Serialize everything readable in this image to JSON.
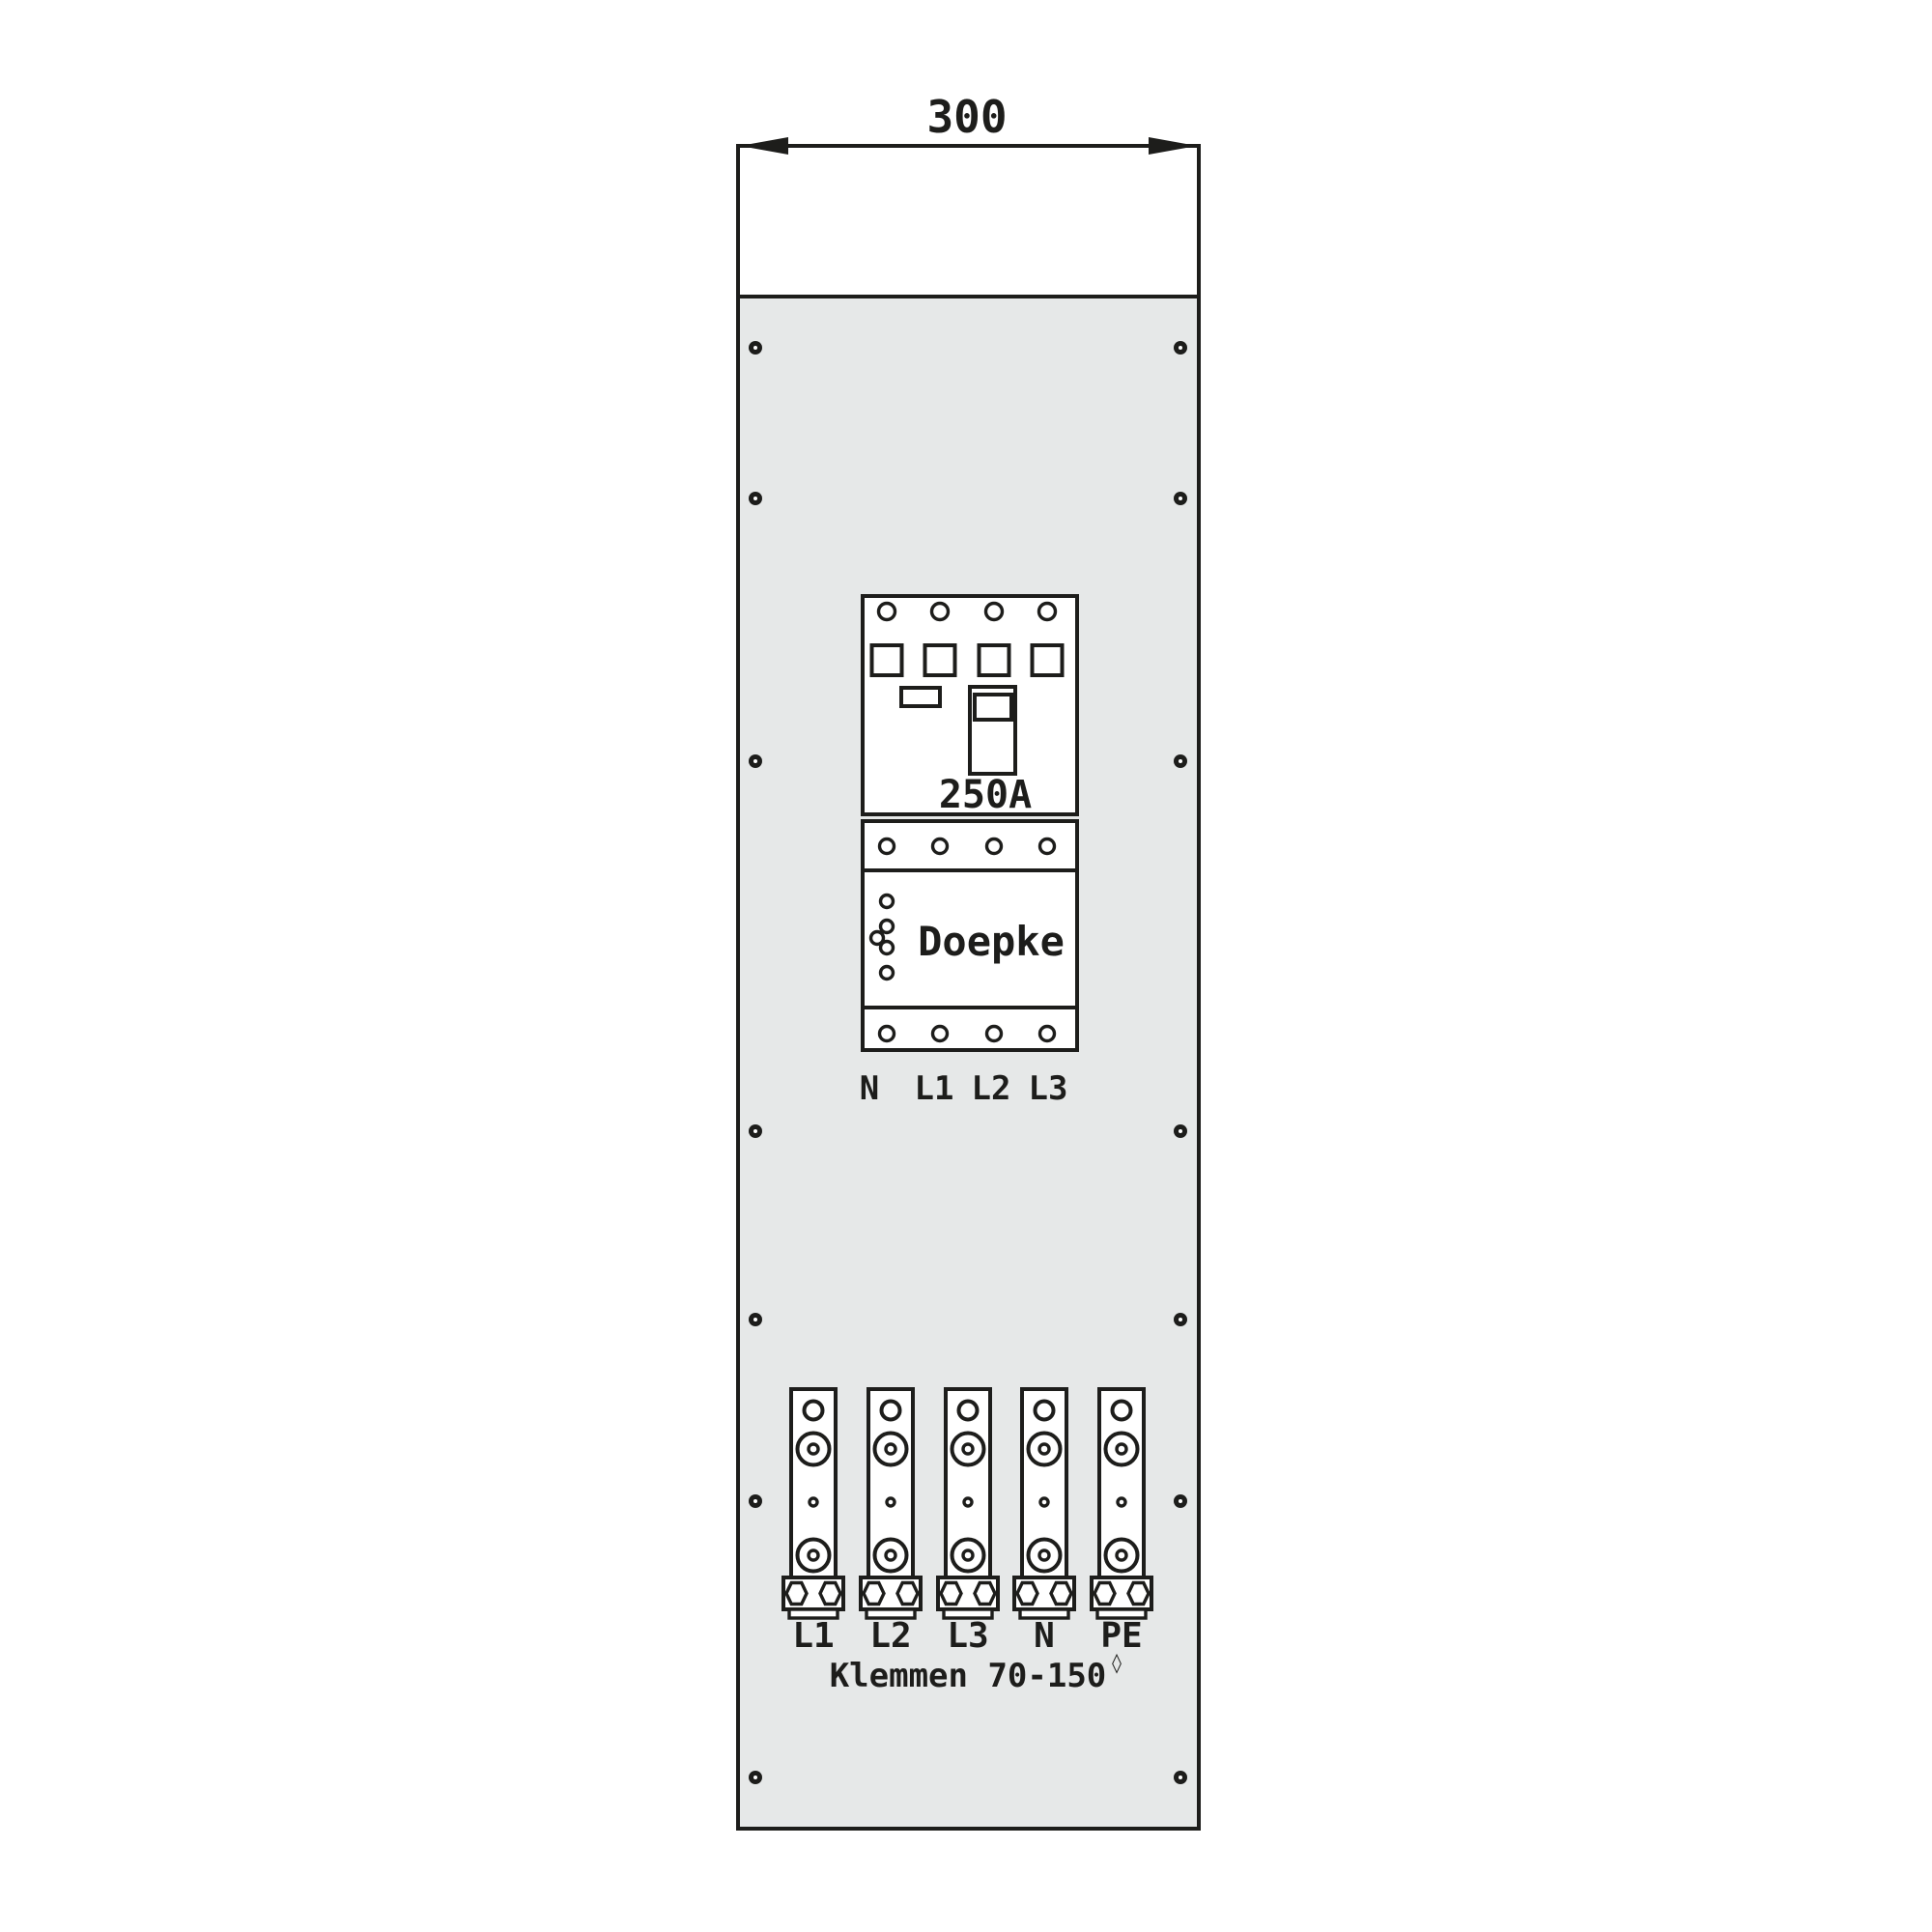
{
  "drawing": {
    "type": "electrical-panel-front-plate"
  },
  "dimension": {
    "width_label": "300"
  },
  "breaker": {
    "rating_label": "250A",
    "brand_label": "Doepke",
    "terminals": [
      "N",
      "L1",
      "L2",
      "L3"
    ]
  },
  "terminal_blocks": {
    "labels": [
      "L1",
      "L2",
      "L3",
      "N",
      "PE"
    ],
    "caption": "Klemmen 70-150",
    "caption_mark": "◊"
  },
  "colors": {
    "line": "#1d1d1b",
    "plate_gray": "#e6e8e8",
    "background": "#ffffff"
  }
}
